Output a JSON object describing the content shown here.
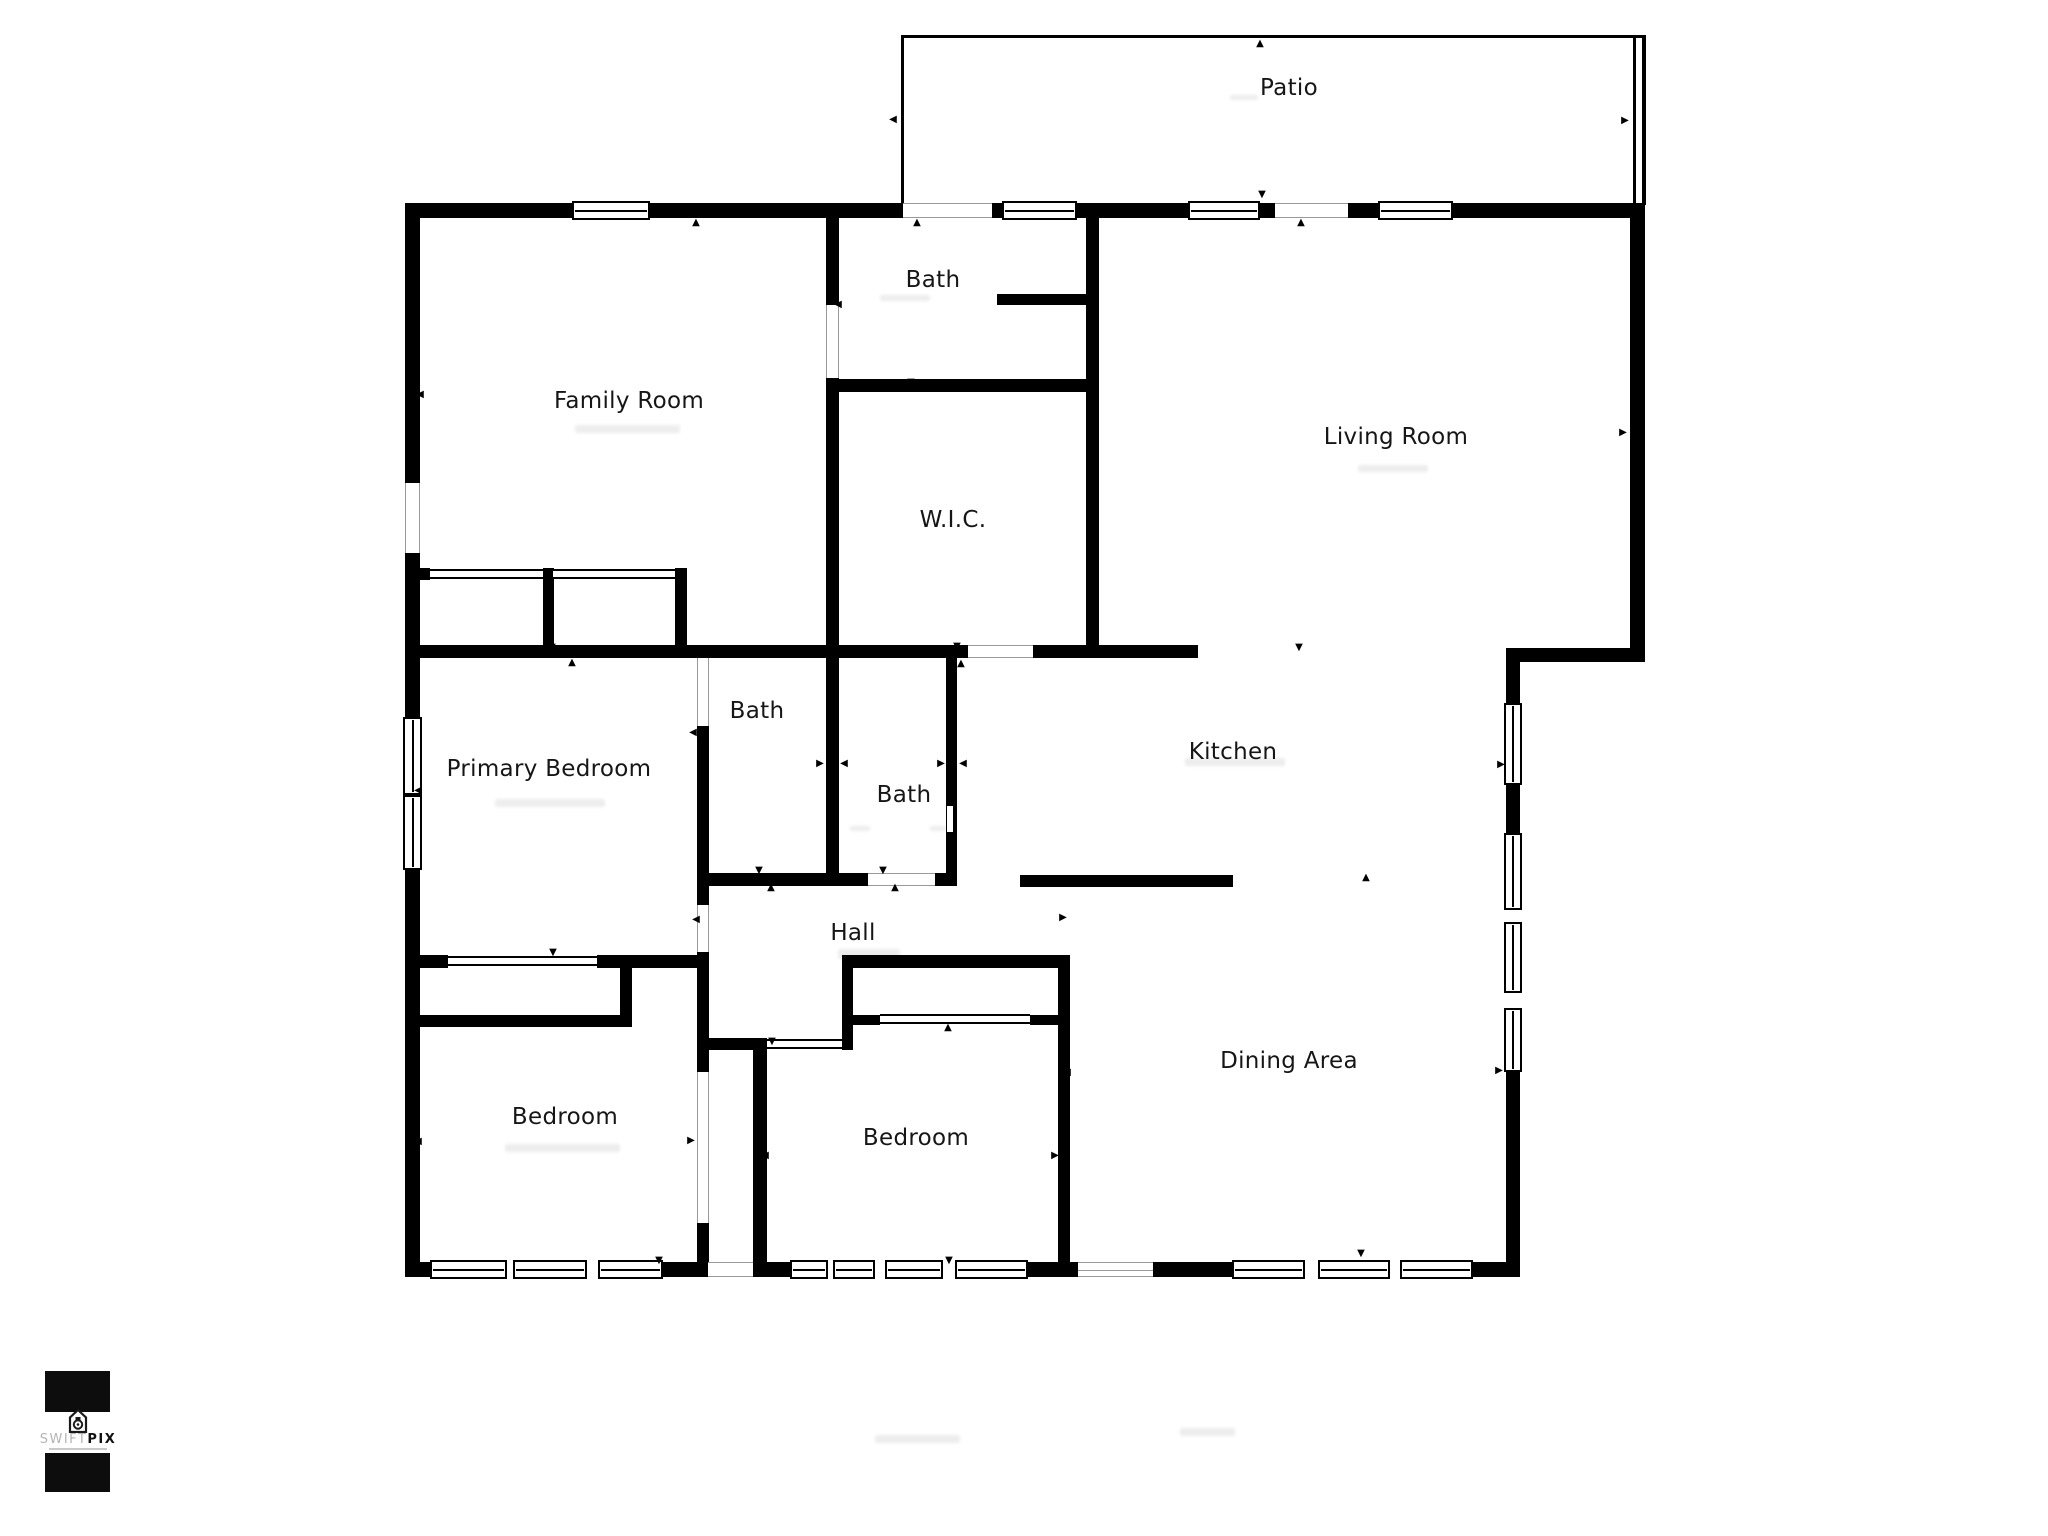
{
  "page": {
    "background": "#ffffff",
    "wall_color": "#000000"
  },
  "rooms": [
    {
      "id": "patio",
      "label": "Patio",
      "x": 1289,
      "y": 88
    },
    {
      "id": "family-room",
      "label": "Family Room",
      "x": 629,
      "y": 401
    },
    {
      "id": "bath-top",
      "label": "Bath",
      "x": 933,
      "y": 280
    },
    {
      "id": "wic",
      "label": "W.I.C.",
      "x": 953,
      "y": 520
    },
    {
      "id": "living-room",
      "label": "Living Room",
      "x": 1396,
      "y": 437
    },
    {
      "id": "primary-bedroom",
      "label": "Primary Bedroom",
      "x": 549,
      "y": 769
    },
    {
      "id": "bath-mid-left",
      "label": "Bath",
      "x": 757,
      "y": 711
    },
    {
      "id": "bath-mid-right",
      "label": "Bath",
      "x": 904,
      "y": 795
    },
    {
      "id": "kitchen",
      "label": "Kitchen",
      "x": 1233,
      "y": 752
    },
    {
      "id": "hall",
      "label": "Hall",
      "x": 853,
      "y": 933
    },
    {
      "id": "dining-area",
      "label": "Dining Area",
      "x": 1289,
      "y": 1061
    },
    {
      "id": "bedroom-left",
      "label": "Bedroom",
      "x": 565,
      "y": 1117
    },
    {
      "id": "bedroom-mid",
      "label": "Bedroom",
      "x": 916,
      "y": 1138
    }
  ],
  "geometry": {
    "walls": [
      [
        405,
        203,
        167,
        15
      ],
      [
        650,
        203,
        253,
        15
      ],
      [
        992,
        203,
        10,
        15
      ],
      [
        1077,
        203,
        111,
        15
      ],
      [
        1260,
        203,
        17,
        15
      ],
      [
        1348,
        203,
        32,
        15
      ],
      [
        1453,
        203,
        192,
        15
      ],
      [
        405,
        203,
        15,
        280
      ],
      [
        405,
        553,
        15,
        164
      ],
      [
        405,
        870,
        15,
        407
      ],
      [
        405,
        1262,
        25,
        15
      ],
      [
        663,
        1262,
        45,
        15
      ],
      [
        753,
        1262,
        37,
        15
      ],
      [
        1028,
        1262,
        50,
        15
      ],
      [
        1153,
        1262,
        79,
        15
      ],
      [
        1473,
        1262,
        45,
        15
      ],
      [
        1630,
        203,
        15,
        459
      ],
      [
        1506,
        648,
        139,
        14
      ],
      [
        1506,
        662,
        14,
        41
      ],
      [
        1506,
        785,
        14,
        48
      ],
      [
        1506,
        1072,
        14,
        205
      ],
      [
        826,
        218,
        13,
        87
      ],
      [
        826,
        378,
        13,
        495
      ],
      [
        826,
        379,
        271,
        13
      ],
      [
        997,
        294,
        89,
        11
      ],
      [
        1086,
        218,
        13,
        440
      ],
      [
        418,
        645,
        550,
        13
      ],
      [
        1033,
        645,
        165,
        13
      ],
      [
        405,
        568,
        25,
        12
      ],
      [
        543,
        568,
        11,
        77
      ],
      [
        675,
        568,
        12,
        77
      ],
      [
        697,
        726,
        12,
        179
      ],
      [
        697,
        952,
        12,
        120
      ],
      [
        697,
        1223,
        12,
        39
      ],
      [
        946,
        658,
        11,
        215
      ],
      [
        697,
        873,
        171,
        13
      ],
      [
        935,
        873,
        22,
        13
      ],
      [
        1020,
        875,
        213,
        12
      ],
      [
        842,
        955,
        228,
        13
      ],
      [
        418,
        955,
        30,
        13
      ],
      [
        597,
        955,
        101,
        13
      ],
      [
        418,
        1015,
        214,
        12
      ],
      [
        620,
        968,
        12,
        47
      ],
      [
        708,
        1038,
        59,
        12
      ],
      [
        753,
        1050,
        14,
        212
      ],
      [
        842,
        955,
        11,
        95
      ],
      [
        852,
        1015,
        28,
        10
      ],
      [
        1030,
        1015,
        30,
        10
      ],
      [
        1058,
        955,
        12,
        307
      ]
    ],
    "windows_h": [
      [
        572,
        201,
        78,
        19
      ],
      [
        1002,
        201,
        75,
        19
      ],
      [
        1188,
        201,
        72,
        19
      ],
      [
        1378,
        201,
        75,
        19
      ],
      [
        430,
        1260,
        77,
        19
      ],
      [
        513,
        1260,
        74,
        19
      ],
      [
        598,
        1260,
        65,
        19
      ],
      [
        790,
        1260,
        38,
        19
      ],
      [
        833,
        1260,
        42,
        19
      ],
      [
        885,
        1260,
        58,
        19
      ],
      [
        955,
        1260,
        73,
        19
      ],
      [
        1232,
        1260,
        73,
        19
      ],
      [
        1318,
        1260,
        72,
        19
      ],
      [
        1400,
        1260,
        73,
        19
      ]
    ],
    "windows_v": [
      [
        403,
        717,
        19,
        78
      ],
      [
        403,
        795,
        19,
        75
      ],
      [
        1504,
        703,
        18,
        82
      ],
      [
        1504,
        833,
        18,
        77
      ],
      [
        1504,
        922,
        18,
        71
      ],
      [
        1504,
        1008,
        18,
        64
      ]
    ],
    "openings_h": [
      [
        903,
        203,
        89,
        15
      ],
      [
        1275,
        203,
        73,
        15
      ],
      [
        968,
        645,
        65,
        13
      ],
      [
        868,
        873,
        67,
        13
      ],
      [
        708,
        1262,
        45,
        15
      ]
    ],
    "openings_slider": [
      [
        1078,
        1262,
        75,
        15
      ]
    ],
    "openings_v": [
      [
        405,
        483,
        15,
        70
      ],
      [
        826,
        305,
        13,
        73
      ],
      [
        697,
        658,
        12,
        68
      ],
      [
        697,
        905,
        12,
        47
      ],
      [
        697,
        1072,
        12,
        151
      ]
    ],
    "tracks": [
      [
        430,
        569,
        113,
        10
      ],
      [
        553,
        569,
        122,
        10
      ],
      [
        448,
        956,
        149,
        10
      ],
      [
        880,
        1014,
        150,
        10
      ],
      [
        767,
        1039,
        75,
        10
      ]
    ],
    "thin_lines": [
      [
        901,
        35,
        744,
        3
      ],
      [
        901,
        35,
        3,
        170
      ],
      [
        1633,
        35,
        3,
        170
      ],
      [
        1642,
        35,
        4,
        170
      ]
    ],
    "notches": [
      [
        947,
        806,
        6,
        26
      ]
    ],
    "smudges": [
      [
        575,
        425,
        105,
        8
      ],
      [
        880,
        295,
        50,
        6
      ],
      [
        1358,
        465,
        70,
        7
      ],
      [
        495,
        799,
        110,
        8
      ],
      [
        850,
        826,
        20,
        5
      ],
      [
        930,
        826,
        16,
        5
      ],
      [
        838,
        949,
        62,
        10
      ],
      [
        1185,
        758,
        100,
        8
      ],
      [
        505,
        1144,
        115,
        8
      ],
      [
        875,
        1435,
        85,
        8
      ],
      [
        1180,
        1428,
        55,
        8
      ],
      [
        1230,
        95,
        28,
        5
      ]
    ]
  },
  "markers": [
    {
      "g": "▲",
      "x": 696,
      "y": 223
    },
    {
      "g": "▲",
      "x": 917,
      "y": 223
    },
    {
      "g": "▲",
      "x": 1301,
      "y": 223
    },
    {
      "g": "▲",
      "x": 1260,
      "y": 44
    },
    {
      "g": "▲",
      "x": 961,
      "y": 664
    },
    {
      "g": "▲",
      "x": 572,
      "y": 663
    },
    {
      "g": "▲",
      "x": 771,
      "y": 888
    },
    {
      "g": "▲",
      "x": 895,
      "y": 888
    },
    {
      "g": "▲",
      "x": 1366,
      "y": 878
    },
    {
      "g": "▲",
      "x": 948,
      "y": 1028
    },
    {
      "g": "▼",
      "x": 1262,
      "y": 195
    },
    {
      "g": "▼",
      "x": 911,
      "y": 383
    },
    {
      "g": "▼",
      "x": 957,
      "y": 647
    },
    {
      "g": "▼",
      "x": 1299,
      "y": 648
    },
    {
      "g": "▼",
      "x": 552,
      "y": 648
    },
    {
      "g": "▼",
      "x": 759,
      "y": 871
    },
    {
      "g": "▼",
      "x": 883,
      "y": 871
    },
    {
      "g": "▼",
      "x": 553,
      "y": 953
    },
    {
      "g": "▼",
      "x": 772,
      "y": 1042
    },
    {
      "g": "▼",
      "x": 659,
      "y": 1261
    },
    {
      "g": "▼",
      "x": 949,
      "y": 1261
    },
    {
      "g": "▼",
      "x": 1361,
      "y": 1254
    },
    {
      "g": "◀",
      "x": 893,
      "y": 120
    },
    {
      "g": "◀",
      "x": 838,
      "y": 305
    },
    {
      "g": "◀",
      "x": 1092,
      "y": 432
    },
    {
      "g": "◀",
      "x": 420,
      "y": 395
    },
    {
      "g": "◀",
      "x": 418,
      "y": 791
    },
    {
      "g": "◀",
      "x": 418,
      "y": 1142
    },
    {
      "g": "◀",
      "x": 693,
      "y": 733
    },
    {
      "g": "◀",
      "x": 844,
      "y": 764
    },
    {
      "g": "◀",
      "x": 963,
      "y": 764
    },
    {
      "g": "◀",
      "x": 696,
      "y": 920
    },
    {
      "g": "◀",
      "x": 765,
      "y": 1156
    },
    {
      "g": "◀",
      "x": 1067,
      "y": 1073
    },
    {
      "g": "▶",
      "x": 1625,
      "y": 121
    },
    {
      "g": "▶",
      "x": 1623,
      "y": 433
    },
    {
      "g": "▶",
      "x": 820,
      "y": 764
    },
    {
      "g": "▶",
      "x": 941,
      "y": 764
    },
    {
      "g": "▶",
      "x": 1501,
      "y": 765
    },
    {
      "g": "▶",
      "x": 1499,
      "y": 1071
    },
    {
      "g": "▶",
      "x": 691,
      "y": 1141
    },
    {
      "g": "▶",
      "x": 1055,
      "y": 1156
    },
    {
      "g": "▶",
      "x": 1063,
      "y": 918
    }
  ],
  "logo": {
    "text_light": "SWIFT",
    "text_bold": "PIX",
    "icon": "house-camera-icon"
  }
}
